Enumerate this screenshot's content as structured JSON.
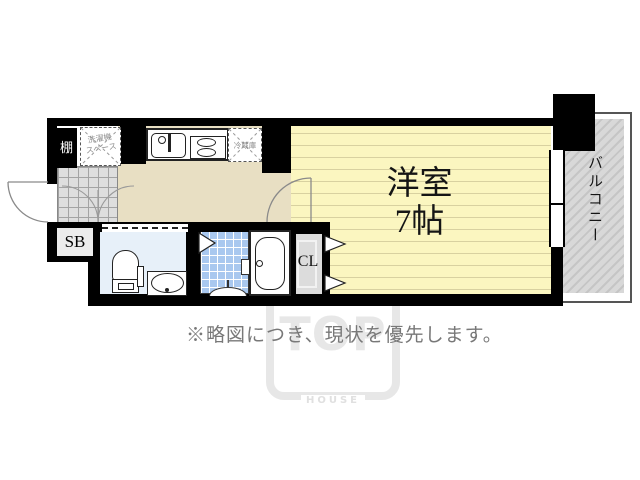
{
  "floorplan": {
    "room_label_line1": "洋室",
    "room_label_line2": "7帖",
    "balcony_label": "バルコニー",
    "closet_label": "CL",
    "shoebox_label": "SB",
    "shelf_label": "棚",
    "washer_space_line1": "洗濯機",
    "washer_space_line2": "スペース",
    "fridge_label": "冷蔵庫"
  },
  "note": {
    "text": "※略図につき、現状を優先します。"
  },
  "watermark": {
    "line1": "TOP",
    "line2": "HOUSE"
  },
  "colors": {
    "wall": "#000000",
    "room_floor": "#fbf6c0",
    "room_floor_lines": "#d8d1a0",
    "kitchen_floor": "#e8dfc3",
    "genkan_tile": "#dedede",
    "toilet_floor": "#e7f0f9",
    "bath_tile": "#a9c8ef",
    "closet_floor": "#dcdcdc",
    "balcony_hatch": "#c5c5c5",
    "note_text": "#787878",
    "watermark": "#e7e7e7"
  }
}
